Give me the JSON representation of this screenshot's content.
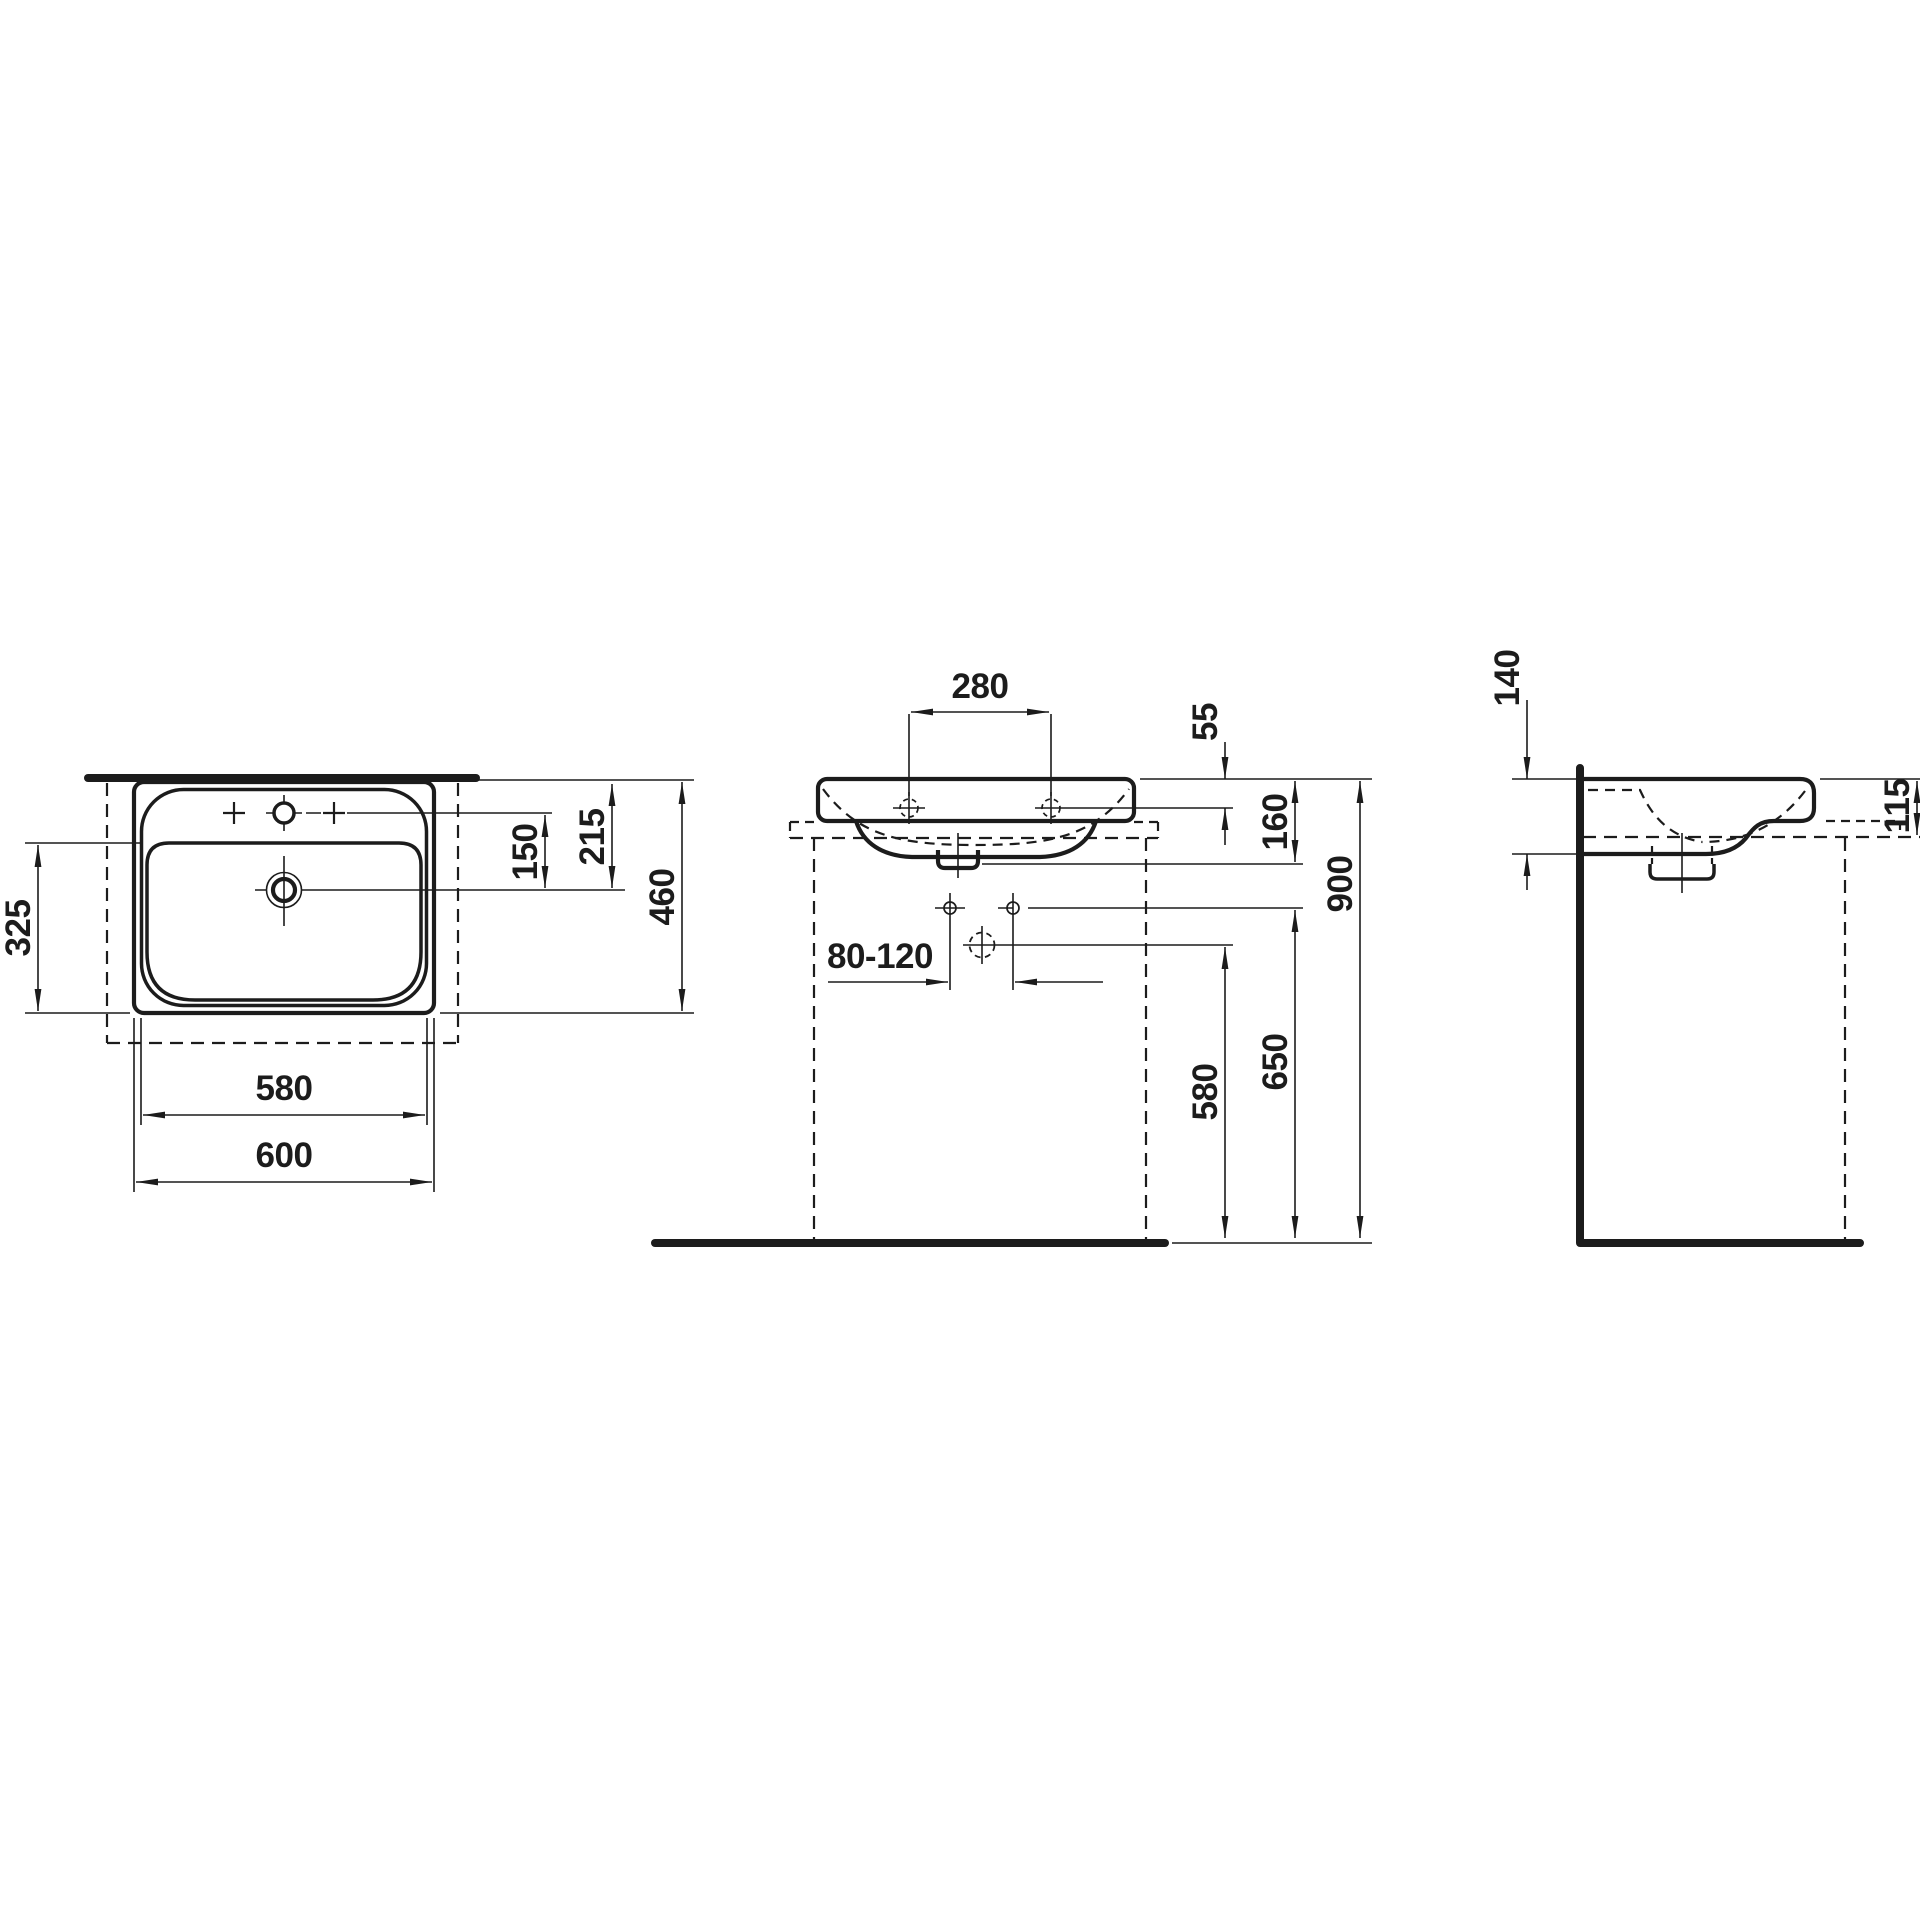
{
  "drawing": {
    "type": "washbasin technical dimension drawing",
    "background": "#ffffff",
    "line_color": "#1c1c1c"
  },
  "views": {
    "top": {
      "label": "top-view",
      "dims": {
        "bowl_depth": "325",
        "basin_width": "580",
        "overall_width": "600",
        "overall_depth": "460",
        "edge_to_drain": "215",
        "taphole_to_drain": "150"
      }
    },
    "front": {
      "label": "front-view",
      "dims": {
        "hole_spacing": "280",
        "top_to_fixing_hole": "55",
        "top_to_outlet": "160",
        "rim_height": "900",
        "supply_height": "650",
        "drain_height": "580",
        "outlet_offset_range": "80-120"
      }
    },
    "side": {
      "label": "side-view",
      "dims": {
        "rear_height": "140",
        "rear_edge_height": "115"
      }
    }
  }
}
